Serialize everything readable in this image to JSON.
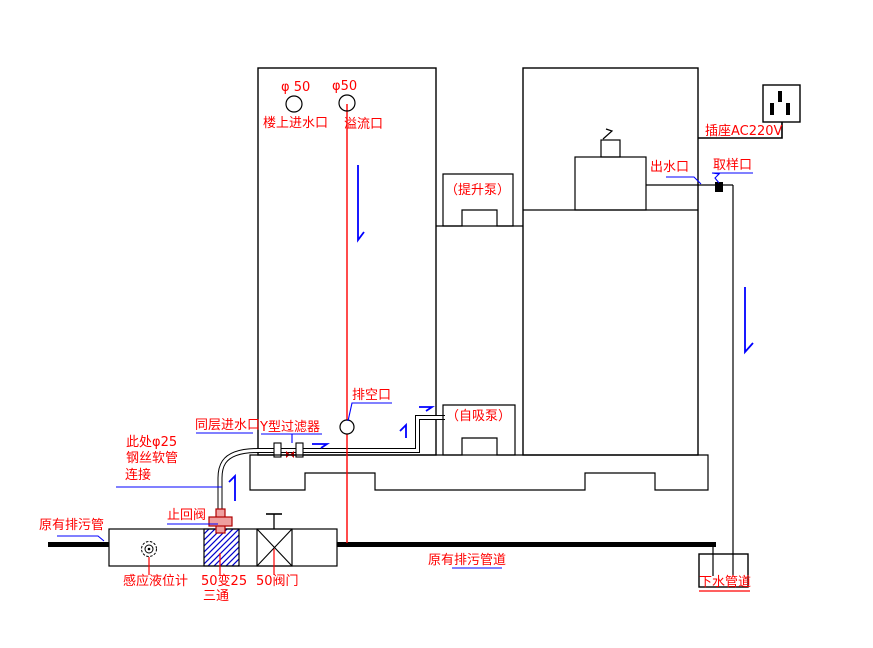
{
  "diagram": {
    "type": "plumbing-installation-schematic",
    "colors": {
      "label_red": "#ff0000",
      "leader_blue": "#0000ff",
      "line_black": "#000000",
      "hatch_blue": "#0000cc",
      "check_valve_fill": "#ef9f9f",
      "sewage_pipe": "#000000"
    },
    "labels": {
      "phi50_left": "φ 50",
      "phi50_right": "φ50",
      "upstairs_inlet": "楼上进水口",
      "overflow_port": "溢流口",
      "lift_pump": "（提升泵）",
      "socket": "插座AC220V",
      "outlet_port": "出水口",
      "sampling_port": "取样口",
      "drain_empty_port": "排空口",
      "same_floor_inlet": "同层进水口",
      "y_filter": "Y型过滤器",
      "self_priming_pump": "（自吸泵）",
      "hose_note_1": "此处φ25",
      "hose_note_2": "钢丝软管",
      "hose_note_3": "连接",
      "check_valve": "止回阀",
      "existing_sewage_pipe": "原有排污管",
      "level_sensor": "感应液位计",
      "tee_1": "50变25",
      "tee_2": "三通",
      "valve_50": "50阀门",
      "existing_sewage_pipeline": "原有排污管道",
      "down_water_pipe": "下水管道"
    }
  }
}
